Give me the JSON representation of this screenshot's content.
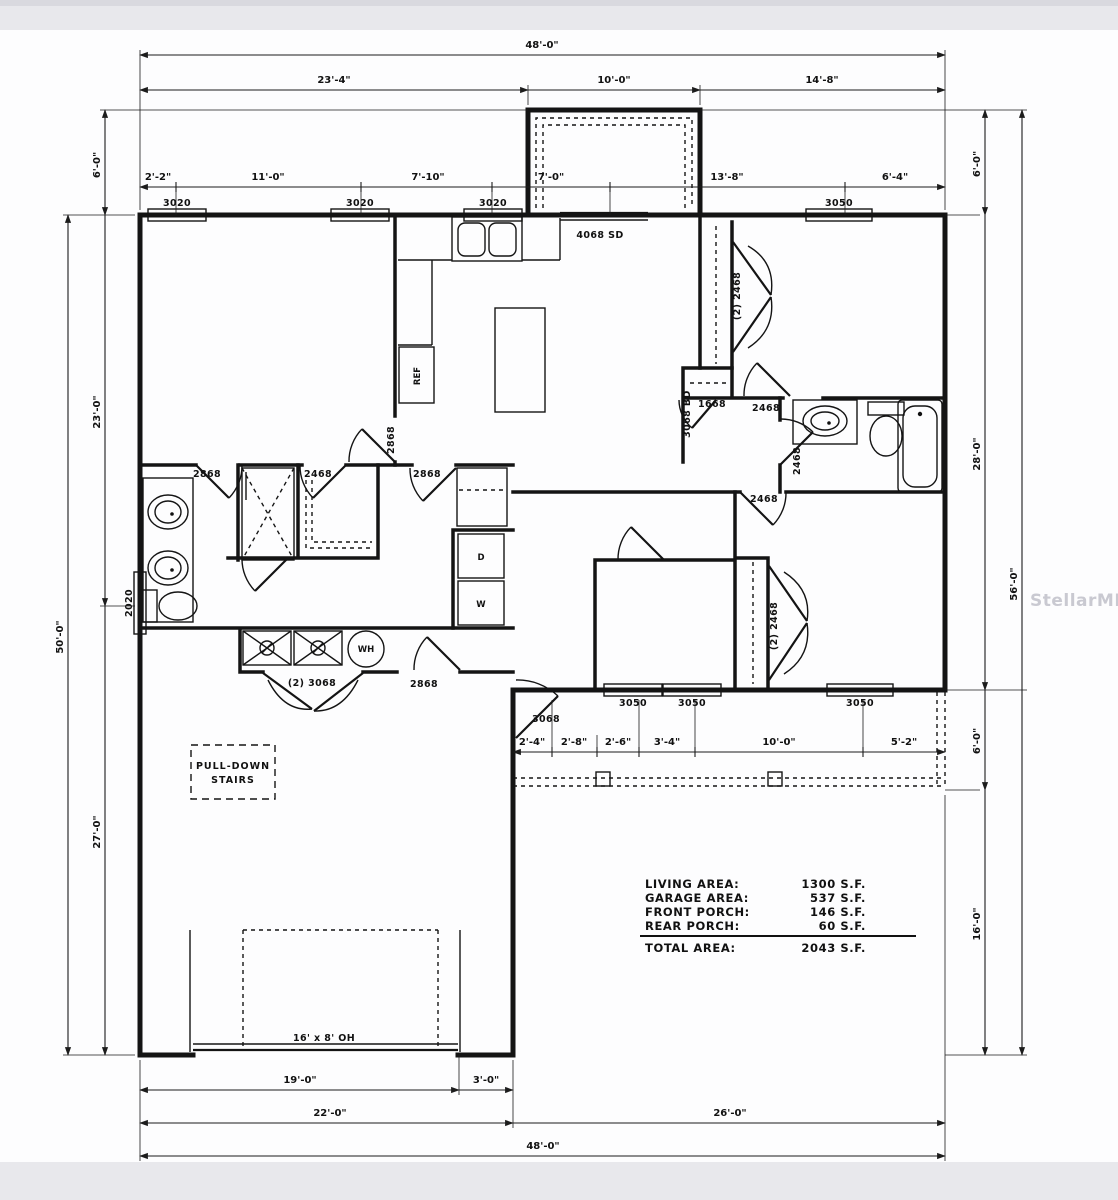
{
  "watermark": "StellarMLS",
  "dims": {
    "overall_w": "48'-0\"",
    "top": [
      "23'-4\"",
      "10'-0\"",
      "14'-8\""
    ],
    "row2": [
      "2'-2\"",
      "11'-0\"",
      "7'-10\"",
      "7'-0\"",
      "13'-8\"",
      "6'-4\""
    ],
    "left": [
      "6'-0\"",
      "23'-0\"",
      "27'-0\"",
      "50'-0\""
    ],
    "right": [
      "6'-0\"",
      "28'-0\"",
      "6'-0\"",
      "16'-0\"",
      "56'-0\""
    ],
    "bottom": [
      "19'-0\"",
      "3'-0\"",
      "22'-0\"",
      "26'-0\"",
      "48'-0\""
    ],
    "porch": [
      "2'-4\"",
      "2'-8\"",
      "2'-6\"",
      "3'-4\"",
      "10'-0\"",
      "5'-2\""
    ]
  },
  "windows": {
    "front": "3020",
    "large": "3050",
    "toilet": "2020"
  },
  "doors": {
    "sliding": "4068 SD",
    "d2868": "2868",
    "d2468": "2468",
    "d3068": "3068",
    "d1668": "1668",
    "bifold": "3068 BD",
    "dbl2468": "(2) 2468",
    "dbl3068": "(2) 3068"
  },
  "fixtures": {
    "ref": "REF",
    "dryer": "D",
    "washer": "W",
    "water_heater": "WH"
  },
  "garage": {
    "door_label": "16' x 8' OH",
    "attic_line1": "PULL-DOWN",
    "attic_line2": "STAIRS"
  },
  "area_table": {
    "rows": [
      {
        "label": "LIVING AREA:",
        "value": "1300 S.F."
      },
      {
        "label": "GARAGE AREA:",
        "value": "537 S.F."
      },
      {
        "label": "FRONT PORCH:",
        "value": "146 S.F."
      },
      {
        "label": "REAR PORCH:",
        "value": "60 S.F."
      }
    ],
    "total_label": "TOTAL AREA:",
    "total_value": "2043 S.F."
  }
}
